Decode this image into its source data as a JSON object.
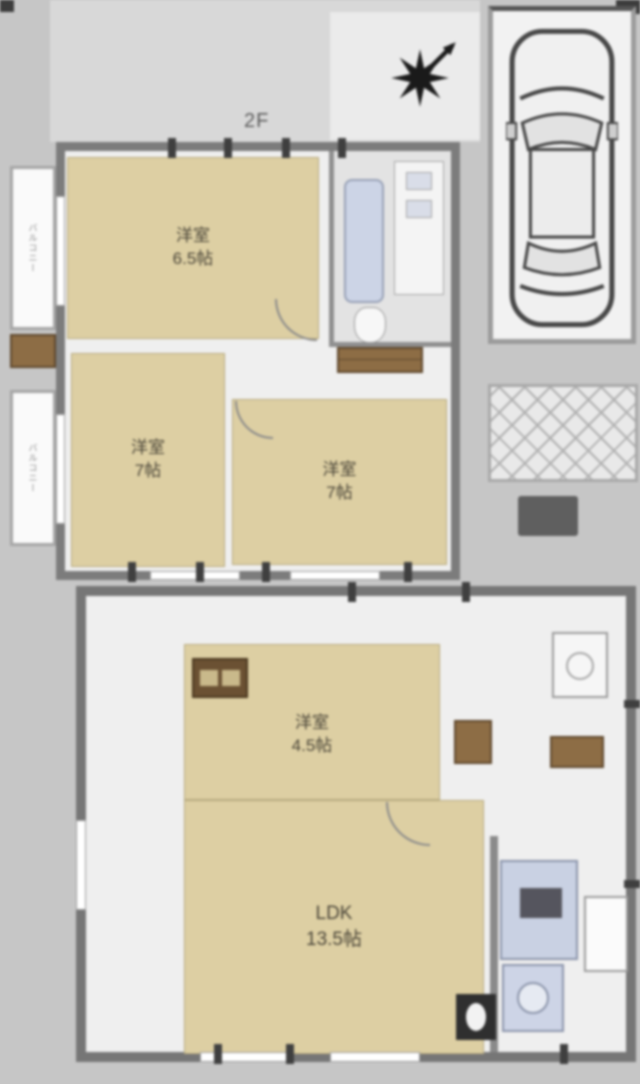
{
  "floor2": {
    "label": "2F",
    "room_a": {
      "name": "洋室",
      "size": "6.5帖"
    },
    "room_b": {
      "name": "洋室",
      "size": "7帖"
    },
    "room_c": {
      "name": "洋室",
      "size": "7帖"
    },
    "balcony_top": {
      "label": "バルコニー"
    },
    "balcony_bottom": {
      "label": "バルコニー"
    }
  },
  "floor1": {
    "label": "1F",
    "room_d": {
      "name": "洋室",
      "size": "4.5帖"
    },
    "ldk": {
      "name": "LDK",
      "size": "13.5帖"
    }
  },
  "colors": {
    "wall": "#7c7c7c",
    "room_fill": "#ddcfa3",
    "closet_brown": "#8d6d45",
    "fixture_blue": "#ccd4e6",
    "background": "#c6c6c6"
  }
}
